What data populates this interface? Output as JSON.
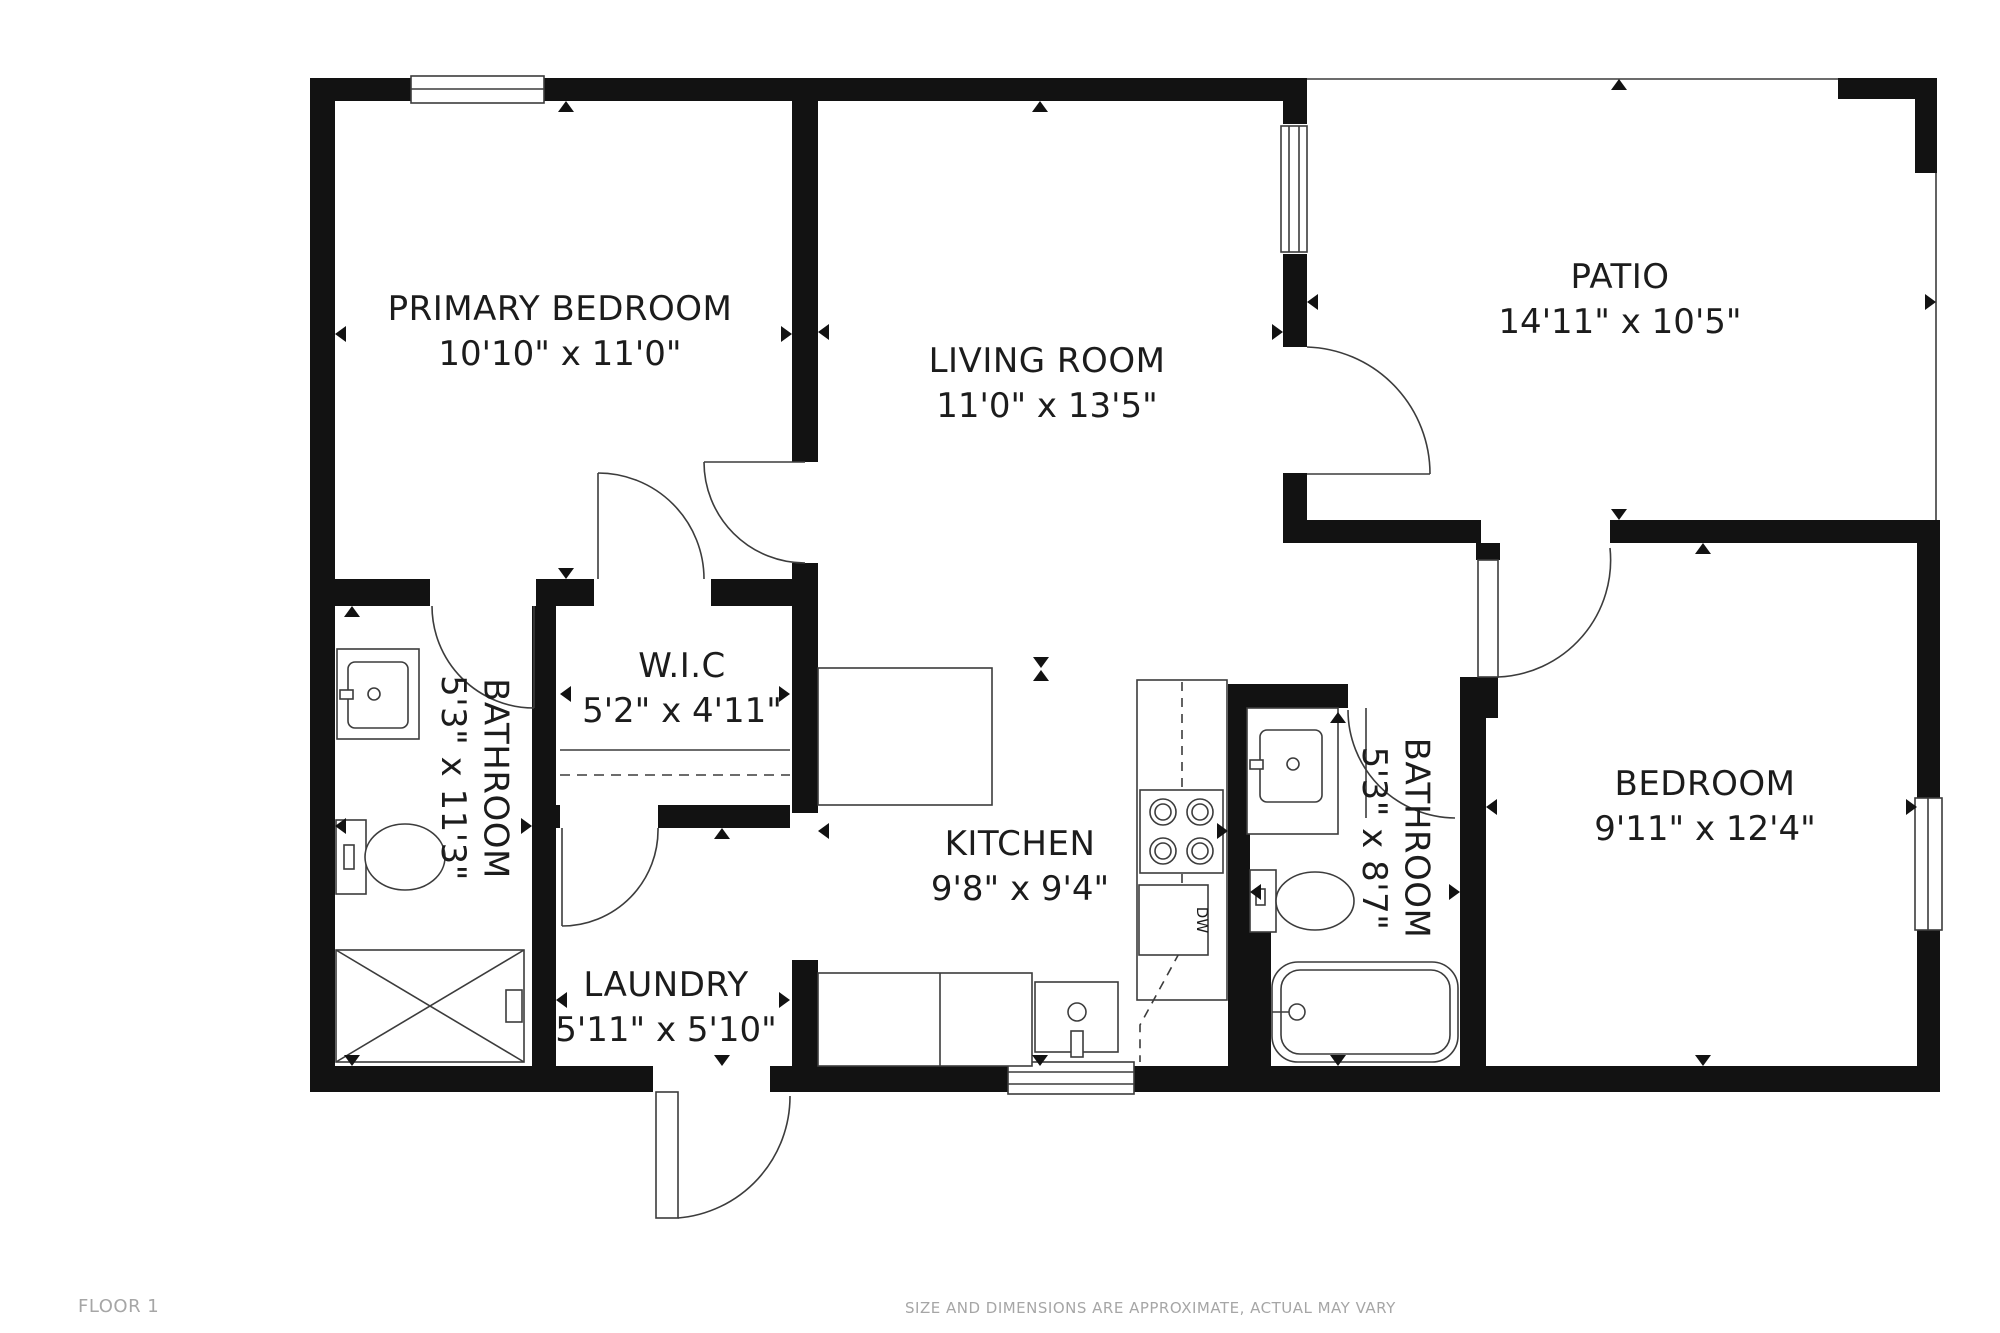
{
  "floorplan": {
    "rooms": [
      {
        "name": "PRIMARY BEDROOM",
        "dimensions": "10'10\" x 11'0\""
      },
      {
        "name": "LIVING ROOM",
        "dimensions": "11'0\" x 13'5\""
      },
      {
        "name": "PATIO",
        "dimensions": "14'11\" x 10'5\""
      },
      {
        "name": "W.I.C",
        "dimensions": "5'2\" x 4'11\""
      },
      {
        "name": "KITCHEN",
        "dimensions": "9'8\" x 9'4\""
      },
      {
        "name": "LAUNDRY",
        "dimensions": "5'11\" x 5'10\""
      },
      {
        "name": "BEDROOM",
        "dimensions": "9'11\" x 12'4\""
      },
      {
        "name": "BATHROOM",
        "dimensions": "5'3\" x 11'3\""
      },
      {
        "name": "BATHROOM",
        "dimensions": "5'3\" x 8'7\""
      }
    ],
    "appliances": {
      "dishwasher_label": "DW"
    },
    "fixtures": [
      "sink-vanity",
      "toilet",
      "shower",
      "bathtub",
      "stove",
      "kitchen-sink",
      "closet-rod"
    ],
    "footer": {
      "floor_label": "FLOOR 1",
      "disclaimer": "SIZE AND DIMENSIONS ARE APPROXIMATE, ACTUAL MAY VARY"
    },
    "colors": {
      "wall": "#121212",
      "line": "#3c3c3c",
      "text": "#1c1c1c",
      "muted": "#a6a6a6"
    }
  }
}
